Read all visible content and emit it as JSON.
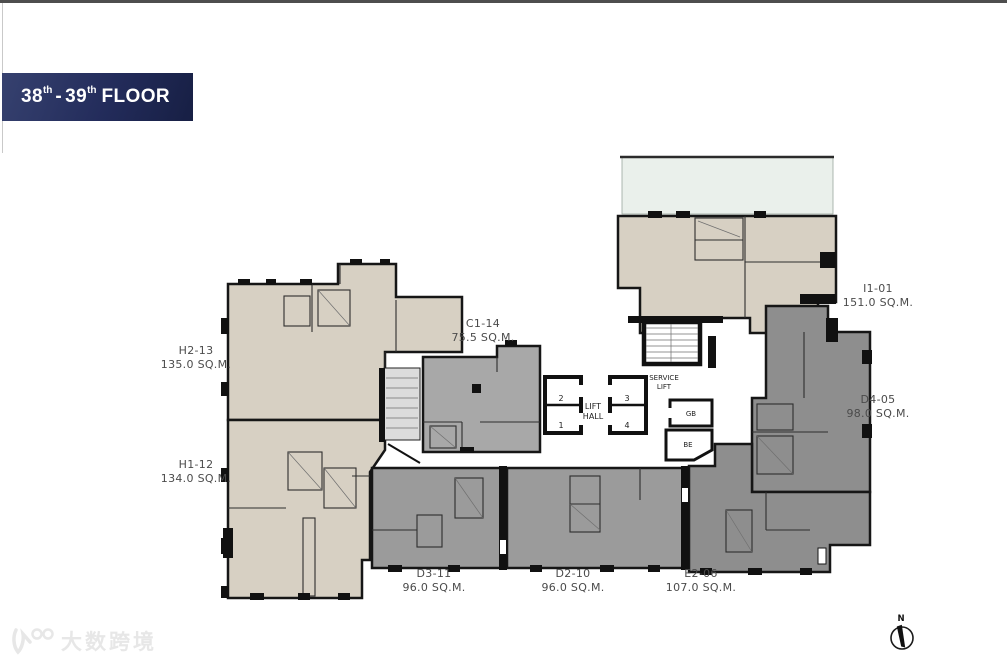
{
  "banner": {
    "floor_from": "38",
    "floor_from_sup": "th",
    "separator": "-",
    "floor_to": "39",
    "floor_to_sup": "th",
    "floor_word": "FLOOR"
  },
  "units": [
    {
      "id": "H2-13",
      "area": "135.0 SQ.M."
    },
    {
      "id": "H1-12",
      "area": "134.0 SQ.M."
    },
    {
      "id": "C1-14",
      "area": "75.5 SQ.M."
    },
    {
      "id": "I1-01",
      "area": "151.0 SQ.M."
    },
    {
      "id": "D4-05",
      "area": "98.0 SQ.M."
    },
    {
      "id": "D3-11",
      "area": "96.0 SQ.M."
    },
    {
      "id": "D2-10",
      "area": "96.0 SQ.M."
    },
    {
      "id": "E2-06",
      "area": "107.0 SQ.M."
    }
  ],
  "core": {
    "lift_hall_line1": "LIFT",
    "lift_hall_line2": "HALL",
    "service_lift_line1": "SERVICE",
    "service_lift_line2": "LIFT",
    "lift_numbers": [
      "1",
      "2",
      "3",
      "4"
    ],
    "room_gb": "GB",
    "room_be": "BE"
  },
  "compass": {
    "north_label": "N"
  },
  "watermark": {
    "text": "大数跨境"
  },
  "colors": {
    "banner_bg": "#232c5b",
    "beige": "#d7d0c3",
    "gray_mid": "#a8a8a8",
    "gray_strip": "#9b9b9b",
    "gray_dark": "#8e8e8e",
    "terrace": "#eaf0eb",
    "wall": "#141414",
    "label_text": "#4b4b4b"
  }
}
